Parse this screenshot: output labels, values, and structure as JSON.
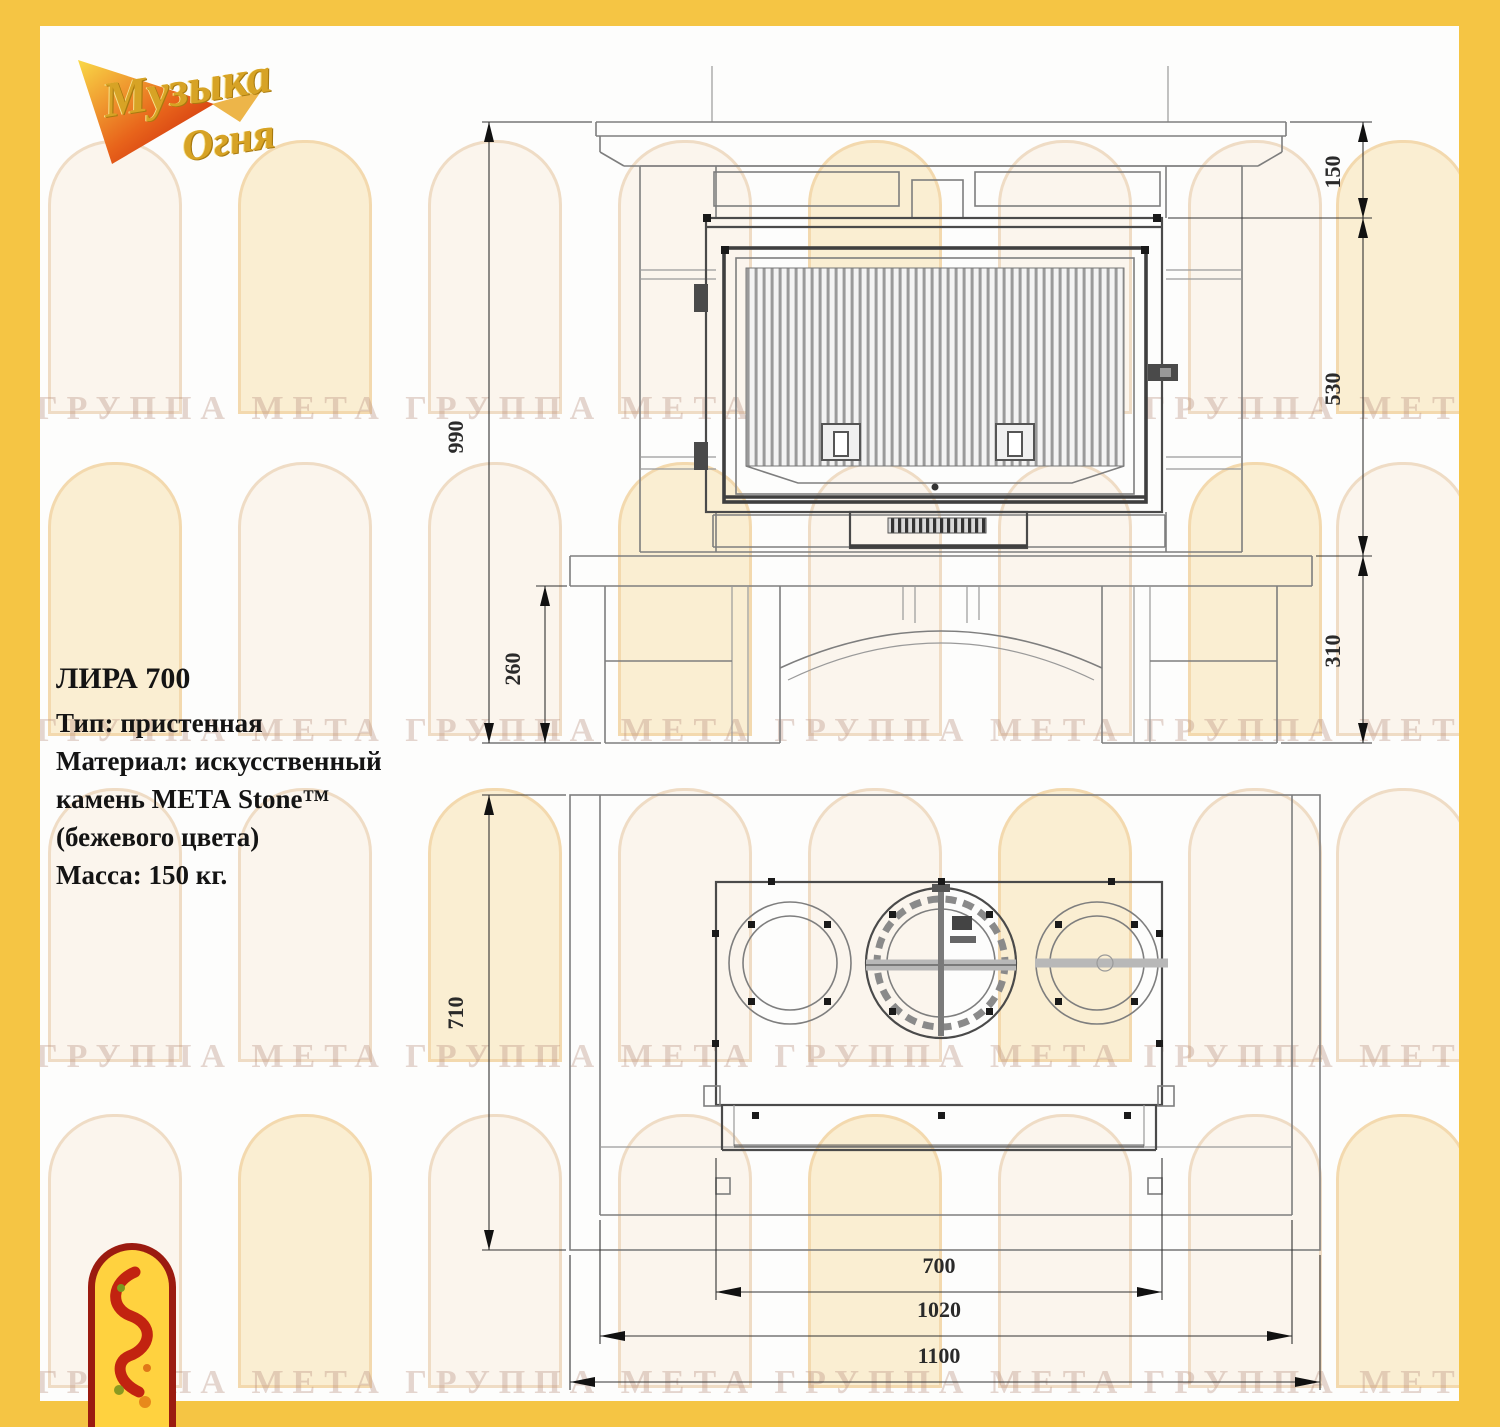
{
  "page": {
    "border_color": "#f5c544",
    "background": "#fdfdfc"
  },
  "brand_logo": {
    "line1": "Музыка",
    "line2": "Огня"
  },
  "product_info": {
    "title": "ЛИРА 700",
    "spec_lines": [
      "Тип: пристенная",
      "Материал: искусственный",
      "камень МЕТА Stone™",
      "(бежевого цвета)",
      "Масса: 150 кг."
    ]
  },
  "watermark": {
    "text": "ГРУППА МЕТА"
  },
  "front_view": {
    "dim_total_height": "990",
    "dim_base_height": "260",
    "dim_top": "150",
    "dim_firebox": "530",
    "dim_lower": "310"
  },
  "plan_view": {
    "dim_depth": "710",
    "dim_firebox_width": "700",
    "dim_body_width": "1020",
    "dim_base_width": "1100"
  }
}
